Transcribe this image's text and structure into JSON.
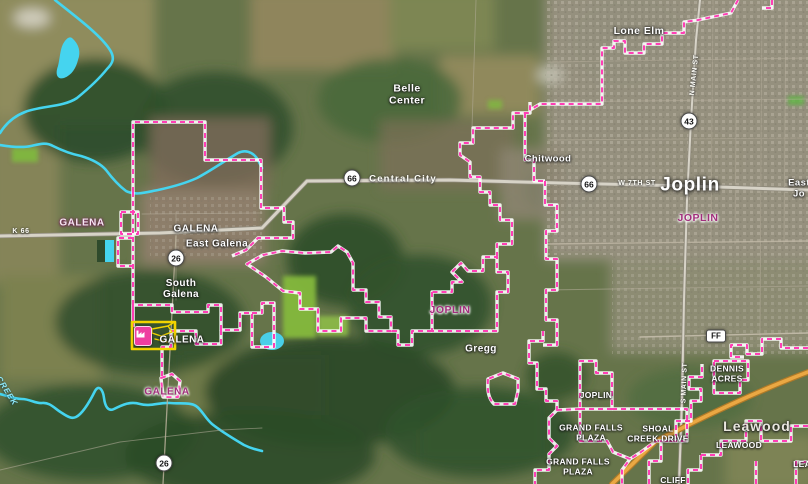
{
  "map": {
    "place_labels": {
      "lone_elm": "Lone Elm",
      "belle_center": "Belle\nCenter",
      "chitwood": "Chitwood",
      "joplin_city": "Joplin",
      "east_joplin": "East Jo",
      "galena_main": "GALENA",
      "east_galena": "East Galena",
      "south_galena": "South\nGalena",
      "galena_selected": "GALENA",
      "gregg": "Gregg",
      "dennis_acres": "DENNIS\nACRES",
      "joplin_sw": "JOPLIN",
      "grand_falls_plaza_1": "GRAND FALLS\nPLAZA",
      "shoal_creek_drive": "SHOAL\nCREEK DRIVE",
      "leawood_big": "Leawood",
      "leawood_small": "LEAWOOD",
      "grand_falls_plaza_2": "GRAND FALLS\nPLAZA",
      "leawood_cut": "LEAW",
      "cliff": "CLIFF"
    },
    "boundary_labels": {
      "galena_nw": "GALENA",
      "joplin_center": "JOPLIN",
      "joplin_east": "JOPLIN",
      "galena_south": "GALENA"
    },
    "road_labels": {
      "k66": "K 66",
      "central_city": "Central City",
      "w_7th_st": "W 7TH ST",
      "n_main_st": "N MAIN ST",
      "s_main_st": "S MAIN ST",
      "creek": "CREEK"
    },
    "shields": {
      "us66_west": "66",
      "us66_east": "66",
      "mo43": "43",
      "k26_north": "26",
      "k26_south": "26",
      "ff": "FF"
    },
    "colors": {
      "boundary": "#ff3eb5",
      "water": "#45d4ef",
      "selection_yellow": "#f2d400",
      "marker_pink": "#ee3fa0",
      "boundary_label": "#a12e7c",
      "interstate_orange": "#e8a33d"
    }
  }
}
